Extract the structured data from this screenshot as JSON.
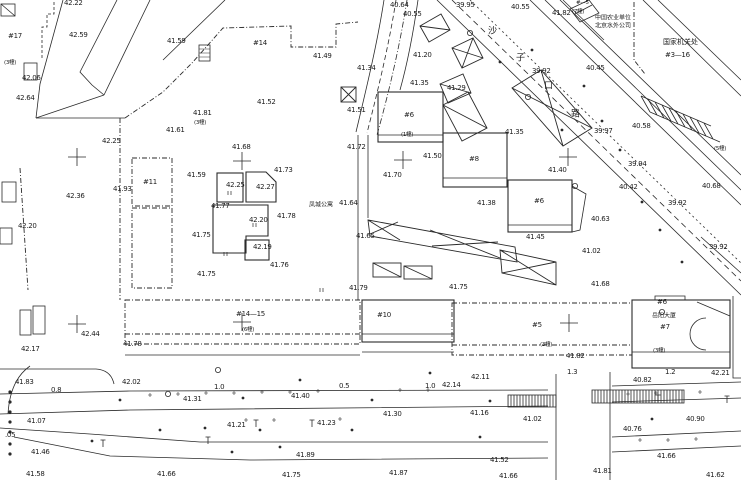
{
  "map": {
    "kind": "topographic-site-plan",
    "background": "#ffffff",
    "ink": "#242424",
    "road_name_vertical": "沙子口路",
    "compound_name": "凤城公寓",
    "tower_name": "岳阳大厦"
  },
  "labels": [
    {
      "x": 64,
      "y": 3,
      "t": "42.22"
    },
    {
      "x": 8,
      "y": 36,
      "t": "#17",
      "c": "b",
      "n": "building-id"
    },
    {
      "x": 69,
      "y": 35,
      "t": "42.59"
    },
    {
      "x": 167,
      "y": 41,
      "t": "41.59"
    },
    {
      "x": 4,
      "y": 62,
      "t": "(3幢)",
      "c": "sm",
      "n": "structure-note"
    },
    {
      "x": 22,
      "y": 78,
      "t": "42.06"
    },
    {
      "x": 16,
      "y": 98,
      "t": "42.64"
    },
    {
      "x": 390,
      "y": 5,
      "t": "40.64"
    },
    {
      "x": 403,
      "y": 14,
      "t": "40.55"
    },
    {
      "x": 456,
      "y": 5,
      "t": "39.95"
    },
    {
      "x": 511,
      "y": 7,
      "t": "40.55"
    },
    {
      "x": 552,
      "y": 13,
      "t": "41.82"
    },
    {
      "x": 576,
      "y": 3,
      "t": "#—5",
      "c": "sm",
      "n": "building-id"
    },
    {
      "x": 572,
      "y": 11,
      "t": "(7幢)",
      "c": "sm",
      "n": "structure-note"
    },
    {
      "x": 595,
      "y": 17,
      "t": "中国农业单位",
      "c": "cn6",
      "n": "owner-label"
    },
    {
      "x": 595,
      "y": 25,
      "t": "北京水外公司",
      "c": "cn6",
      "n": "owner-label"
    },
    {
      "x": 663,
      "y": 42,
      "t": "国家机关处",
      "c": "cn",
      "n": "owner-label"
    },
    {
      "x": 665,
      "y": 55,
      "t": "#3—16",
      "c": "b",
      "n": "building-id"
    },
    {
      "x": 532,
      "y": 71,
      "t": "39.92"
    },
    {
      "x": 586,
      "y": 68,
      "t": "40.45"
    },
    {
      "x": 488,
      "y": 30,
      "t": "沙",
      "c": "rn",
      "n": "road-name-char"
    },
    {
      "x": 516,
      "y": 57,
      "t": "子",
      "c": "rn",
      "n": "road-name-char"
    },
    {
      "x": 544,
      "y": 85,
      "t": "口",
      "c": "rn",
      "n": "road-name-char"
    },
    {
      "x": 571,
      "y": 113,
      "t": "路",
      "c": "rn",
      "n": "road-name-char"
    },
    {
      "x": 313,
      "y": 56,
      "t": "41.49"
    },
    {
      "x": 253,
      "y": 43,
      "t": "#14",
      "c": "b",
      "n": "building-id"
    },
    {
      "x": 257,
      "y": 102,
      "t": "41.52"
    },
    {
      "x": 347,
      "y": 110,
      "t": "41.51"
    },
    {
      "x": 193,
      "y": 113,
      "t": "41.81"
    },
    {
      "x": 194,
      "y": 122,
      "t": "(3幢)",
      "c": "sm",
      "n": "structure-note"
    },
    {
      "x": 166,
      "y": 130,
      "t": "41.61"
    },
    {
      "x": 102,
      "y": 141,
      "t": "42.25"
    },
    {
      "x": 357,
      "y": 68,
      "t": "41.34"
    },
    {
      "x": 413,
      "y": 55,
      "t": "41.20"
    },
    {
      "x": 410,
      "y": 83,
      "t": "41.35"
    },
    {
      "x": 447,
      "y": 88,
      "t": "41.29"
    },
    {
      "x": 505,
      "y": 132,
      "t": "41.35"
    },
    {
      "x": 594,
      "y": 131,
      "t": "39.97"
    },
    {
      "x": 632,
      "y": 126,
      "t": "40.58"
    },
    {
      "x": 714,
      "y": 148,
      "t": "(5幢)",
      "c": "sm",
      "n": "structure-note"
    },
    {
      "x": 628,
      "y": 164,
      "t": "39.94"
    },
    {
      "x": 619,
      "y": 187,
      "t": "40.42"
    },
    {
      "x": 702,
      "y": 186,
      "t": "40.68"
    },
    {
      "x": 668,
      "y": 203,
      "t": "39.92"
    },
    {
      "x": 709,
      "y": 247,
      "t": "39.92"
    },
    {
      "x": 591,
      "y": 219,
      "t": "40.63"
    },
    {
      "x": 113,
      "y": 189,
      "t": "41.93"
    },
    {
      "x": 66,
      "y": 196,
      "t": "42.36"
    },
    {
      "x": 18,
      "y": 226,
      "t": "42.20"
    },
    {
      "x": 143,
      "y": 182,
      "t": "#11",
      "c": "b",
      "n": "building-id"
    },
    {
      "x": 232,
      "y": 147,
      "t": "41.68"
    },
    {
      "x": 274,
      "y": 170,
      "t": "41.73"
    },
    {
      "x": 187,
      "y": 175,
      "t": "41.59"
    },
    {
      "x": 226,
      "y": 185,
      "t": "42.25"
    },
    {
      "x": 256,
      "y": 187,
      "t": "42.27"
    },
    {
      "x": 211,
      "y": 206,
      "t": "41.77"
    },
    {
      "x": 249,
      "y": 220,
      "t": "42.20"
    },
    {
      "x": 277,
      "y": 216,
      "t": "41.78"
    },
    {
      "x": 192,
      "y": 235,
      "t": "41.75"
    },
    {
      "x": 253,
      "y": 247,
      "t": "42.19"
    },
    {
      "x": 270,
      "y": 265,
      "t": "41.76"
    },
    {
      "x": 197,
      "y": 274,
      "t": "41.75"
    },
    {
      "x": 347,
      "y": 147,
      "t": "41.72"
    },
    {
      "x": 423,
      "y": 156,
      "t": "41.50"
    },
    {
      "x": 469,
      "y": 159,
      "t": "#8",
      "c": "b",
      "n": "building-id"
    },
    {
      "x": 383,
      "y": 175,
      "t": "41.70"
    },
    {
      "x": 309,
      "y": 204,
      "t": "凤城公寓",
      "c": "cn6",
      "n": "compound-name"
    },
    {
      "x": 339,
      "y": 203,
      "t": "41.64"
    },
    {
      "x": 477,
      "y": 203,
      "t": "41.38"
    },
    {
      "x": 356,
      "y": 236,
      "t": "41.65"
    },
    {
      "x": 548,
      "y": 170,
      "t": "41.40"
    },
    {
      "x": 534,
      "y": 201,
      "t": "#6",
      "c": "b",
      "n": "building-id"
    },
    {
      "x": 404,
      "y": 115,
      "t": "#6",
      "c": "b",
      "n": "building-id"
    },
    {
      "x": 401,
      "y": 134,
      "t": "(1幢)",
      "c": "sm",
      "n": "structure-note"
    },
    {
      "x": 526,
      "y": 237,
      "t": "41.45"
    },
    {
      "x": 582,
      "y": 251,
      "t": "41.02"
    },
    {
      "x": 591,
      "y": 284,
      "t": "41.68"
    },
    {
      "x": 349,
      "y": 288,
      "t": "41.79"
    },
    {
      "x": 449,
      "y": 287,
      "t": "41.75"
    },
    {
      "x": 236,
      "y": 314,
      "t": "#14—15",
      "c": "b",
      "n": "building-id"
    },
    {
      "x": 242,
      "y": 329,
      "t": "(6幢)",
      "c": "sm",
      "n": "structure-note"
    },
    {
      "x": 377,
      "y": 315,
      "t": "#10",
      "c": "b",
      "n": "building-id"
    },
    {
      "x": 532,
      "y": 325,
      "t": "#5",
      "c": "b",
      "n": "building-id"
    },
    {
      "x": 540,
      "y": 344,
      "t": "(3幢)",
      "c": "sm",
      "n": "structure-note"
    },
    {
      "x": 657,
      "y": 302,
      "t": "#6",
      "c": "b",
      "n": "building-id"
    },
    {
      "x": 652,
      "y": 315,
      "t": "岳阳大厦",
      "c": "cn6",
      "n": "tower-name"
    },
    {
      "x": 660,
      "y": 327,
      "t": "#7",
      "c": "b",
      "n": "building-id"
    },
    {
      "x": 653,
      "y": 350,
      "t": "(3幢)",
      "c": "sm",
      "n": "structure-note"
    },
    {
      "x": 566,
      "y": 356,
      "t": "41.82"
    },
    {
      "x": 567,
      "y": 372,
      "t": "1.3",
      "n": "dimension"
    },
    {
      "x": 665,
      "y": 372,
      "t": "1.2",
      "n": "dimension"
    },
    {
      "x": 711,
      "y": 373,
      "t": "42.21"
    },
    {
      "x": 633,
      "y": 380,
      "t": "40.82"
    },
    {
      "x": 471,
      "y": 377,
      "t": "42.11"
    },
    {
      "x": 442,
      "y": 385,
      "t": "42.14"
    },
    {
      "x": 425,
      "y": 386,
      "t": "1.0",
      "n": "dimension"
    },
    {
      "x": 383,
      "y": 414,
      "t": "41.30"
    },
    {
      "x": 470,
      "y": 413,
      "t": "41.16"
    },
    {
      "x": 523,
      "y": 419,
      "t": "41.02"
    },
    {
      "x": 490,
      "y": 460,
      "t": "41.52"
    },
    {
      "x": 389,
      "y": 473,
      "t": "41.87"
    },
    {
      "x": 499,
      "y": 476,
      "t": "41.66"
    },
    {
      "x": 686,
      "y": 419,
      "t": "40.90"
    },
    {
      "x": 623,
      "y": 429,
      "t": "40.76"
    },
    {
      "x": 657,
      "y": 456,
      "t": "41.66"
    },
    {
      "x": 593,
      "y": 471,
      "t": "41.81"
    },
    {
      "x": 706,
      "y": 475,
      "t": "41.62"
    },
    {
      "x": 81,
      "y": 334,
      "t": "42.44"
    },
    {
      "x": 21,
      "y": 349,
      "t": "42.17"
    },
    {
      "x": 123,
      "y": 344,
      "t": "41.78"
    },
    {
      "x": 15,
      "y": 382,
      "t": "41.83"
    },
    {
      "x": 51,
      "y": 390,
      "t": "0.8",
      "n": "dimension"
    },
    {
      "x": 122,
      "y": 382,
      "t": "42.02"
    },
    {
      "x": 27,
      "y": 421,
      "t": "41.07"
    },
    {
      "x": 5,
      "y": 435,
      "t": ".05"
    },
    {
      "x": 31,
      "y": 452,
      "t": "41.46"
    },
    {
      "x": 26,
      "y": 474,
      "t": "41.58"
    },
    {
      "x": 157,
      "y": 474,
      "t": "41.66"
    },
    {
      "x": 214,
      "y": 387,
      "t": "1.0",
      "n": "dimension"
    },
    {
      "x": 339,
      "y": 386,
      "t": "0.5",
      "n": "dimension"
    },
    {
      "x": 183,
      "y": 399,
      "t": "41.31"
    },
    {
      "x": 291,
      "y": 396,
      "t": "41.40"
    },
    {
      "x": 227,
      "y": 425,
      "t": "41.21"
    },
    {
      "x": 317,
      "y": 423,
      "t": "41.23"
    },
    {
      "x": 296,
      "y": 455,
      "t": "41.89"
    },
    {
      "x": 282,
      "y": 475,
      "t": "41.75"
    }
  ],
  "survey_crosses": [
    [
      77,
      157
    ],
    [
      242,
      161
    ],
    [
      403,
      160
    ],
    [
      568,
      157
    ],
    [
      77,
      324
    ],
    [
      242,
      322
    ],
    [
      569,
      323
    ]
  ],
  "symbols": [
    {
      "t": "circ",
      "x": 470,
      "y": 33
    },
    {
      "t": "circ",
      "x": 528,
      "y": 97
    },
    {
      "t": "circ",
      "x": 575,
      "y": 186
    },
    {
      "t": "circ",
      "x": 218,
      "y": 370
    },
    {
      "t": "circ",
      "x": 662,
      "y": 312
    },
    {
      "t": "circ",
      "x": 168,
      "y": 394
    },
    {
      "t": "pole",
      "x": 256,
      "y": 424
    },
    {
      "t": "pole",
      "x": 312,
      "y": 424
    },
    {
      "t": "pole",
      "x": 658,
      "y": 399
    },
    {
      "t": "pole",
      "x": 208,
      "y": 441
    },
    {
      "t": "pole",
      "x": 103,
      "y": 444
    },
    {
      "t": "pole",
      "x": 727,
      "y": 400
    },
    {
      "t": "dot",
      "x": 300,
      "y": 380
    },
    {
      "t": "dot",
      "x": 260,
      "y": 430
    },
    {
      "t": "dot",
      "x": 205,
      "y": 428
    },
    {
      "t": "dot",
      "x": 430,
      "y": 373
    },
    {
      "t": "dot",
      "x": 652,
      "y": 419
    },
    {
      "t": "dot",
      "x": 120,
      "y": 400
    },
    {
      "t": "dot",
      "x": 160,
      "y": 430
    },
    {
      "t": "dot",
      "x": 243,
      "y": 398
    },
    {
      "t": "dot",
      "x": 372,
      "y": 400
    },
    {
      "t": "dot",
      "x": 490,
      "y": 401
    },
    {
      "t": "dot",
      "x": 92,
      "y": 441
    },
    {
      "t": "dot",
      "x": 280,
      "y": 447
    },
    {
      "t": "dot",
      "x": 352,
      "y": 430
    },
    {
      "t": "dot",
      "x": 232,
      "y": 452
    },
    {
      "t": "dot",
      "x": 480,
      "y": 437
    },
    {
      "t": "dot",
      "x": 584,
      "y": 86
    },
    {
      "t": "dot",
      "x": 602,
      "y": 121
    },
    {
      "t": "dot",
      "x": 620,
      "y": 150
    },
    {
      "t": "dot",
      "x": 532,
      "y": 50
    },
    {
      "t": "dot",
      "x": 500,
      "y": 62
    },
    {
      "t": "dot",
      "x": 562,
      "y": 130
    },
    {
      "t": "dot",
      "x": 660,
      "y": 230
    },
    {
      "t": "dot",
      "x": 682,
      "y": 262
    },
    {
      "t": "dot",
      "x": 642,
      "y": 202
    },
    {
      "t": "dot2",
      "x": 10,
      "y": 392
    },
    {
      "t": "dot2",
      "x": 10,
      "y": 402
    },
    {
      "t": "dot2",
      "x": 10,
      "y": 412
    },
    {
      "t": "dot2",
      "x": 10,
      "y": 422
    },
    {
      "t": "dot2",
      "x": 10,
      "y": 432
    },
    {
      "t": "dot2",
      "x": 10,
      "y": 444
    },
    {
      "t": "dot2",
      "x": 10,
      "y": 454
    },
    {
      "t": "tick",
      "x": 150,
      "y": 395
    },
    {
      "t": "tick",
      "x": 178,
      "y": 394
    },
    {
      "t": "tick",
      "x": 206,
      "y": 393
    },
    {
      "t": "tick",
      "x": 234,
      "y": 393
    },
    {
      "t": "tick",
      "x": 262,
      "y": 392
    },
    {
      "t": "tick",
      "x": 290,
      "y": 392
    },
    {
      "t": "tick",
      "x": 318,
      "y": 391
    },
    {
      "t": "tick",
      "x": 400,
      "y": 390
    },
    {
      "t": "tick",
      "x": 428,
      "y": 390
    },
    {
      "t": "tick",
      "x": 246,
      "y": 420
    },
    {
      "t": "tick",
      "x": 274,
      "y": 420
    },
    {
      "t": "tick",
      "x": 340,
      "y": 419
    },
    {
      "t": "tick",
      "x": 628,
      "y": 394
    },
    {
      "t": "tick",
      "x": 656,
      "y": 393
    },
    {
      "t": "tick",
      "x": 700,
      "y": 392
    },
    {
      "t": "tick",
      "x": 640,
      "y": 440
    },
    {
      "t": "tick",
      "x": 668,
      "y": 440
    },
    {
      "t": "tick",
      "x": 696,
      "y": 439
    },
    {
      "t": "ii",
      "x": 228,
      "y": 193
    },
    {
      "t": "ii",
      "x": 253,
      "y": 225
    },
    {
      "t": "ii",
      "x": 224,
      "y": 254
    },
    {
      "t": "ii",
      "x": 320,
      "y": 290
    }
  ]
}
